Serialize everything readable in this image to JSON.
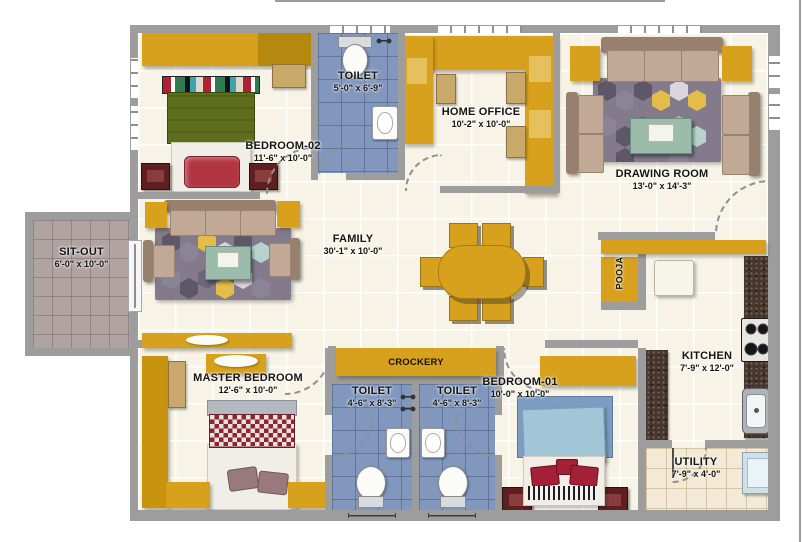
{
  "rooms": {
    "sit_out": {
      "name": "SIT-OUT",
      "dims": "6'-0\" x 10'-0\""
    },
    "bedroom_02": {
      "name": "BEDROOM-02",
      "dims": "11'-6\" x 10'-0\""
    },
    "toilet_top": {
      "name": "TOILET",
      "dims": "5'-0\" x 6'-9\""
    },
    "home_office": {
      "name": "HOME OFFICE",
      "dims": "10'-2\" x 10'-0\""
    },
    "drawing_room": {
      "name": "DRAWING ROOM",
      "dims": "13'-0\" x 14'-3\""
    },
    "family": {
      "name": "FAMILY",
      "dims": "30'-1\" x 10'-0\""
    },
    "pooja": {
      "name": "POOJA"
    },
    "crockery": {
      "name": "CROCKERY"
    },
    "master_bedroom": {
      "name": "MASTER BEDROOM",
      "dims": "12'-6\" x 10'-0\""
    },
    "toilet_left": {
      "name": "TOILET",
      "dims": "4'-6\" x 8'-3\""
    },
    "toilet_right": {
      "name": "TOILET",
      "dims": "4'-6\" x 8'-3\""
    },
    "bedroom_01": {
      "name": "BEDROOM-01",
      "dims": "10'-0\" x 10'-0\""
    },
    "kitchen": {
      "name": "KITCHEN",
      "dims": "7'-9\" x 12'-0\""
    },
    "utility": {
      "name": "UTILITY",
      "dims": "7'-9\" x 4'-0\""
    }
  },
  "colors": {
    "wall_gray": "#9d9d9d",
    "furniture_mustard": "#d7a11d",
    "toilet_floor_blue": "#8197bd",
    "sitout_floor_mauve": "#b2a3a3",
    "utility_floor_beige": "#f2ead6",
    "main_floor_cream": "#f7f3e7",
    "sofa_tan": "#c2a995",
    "rug_gray": "#837b8c",
    "granite_brown": "#46362e",
    "bed_red": "#a32036",
    "bed_blue": "#a2c6d8"
  }
}
